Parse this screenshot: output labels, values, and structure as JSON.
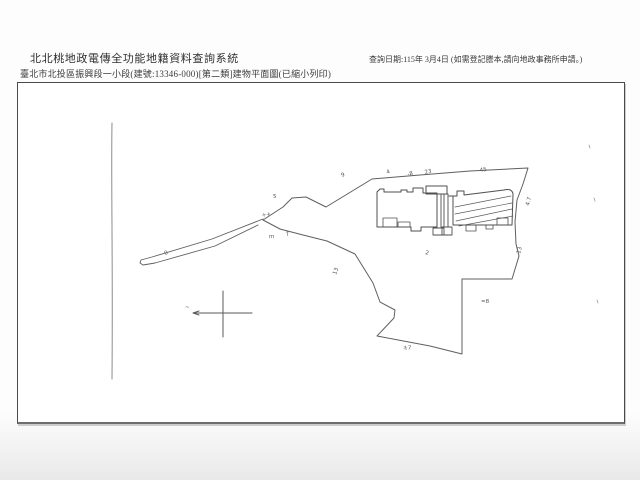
{
  "header": {
    "system_title": "北北桃地政電傳全功能地籍資料查詢系統",
    "document_title": "臺北市北投區振興段一小段(建號:13346-000)[第二類]建物平面圖(已縮小列印)",
    "query_date_note": "查詢日期:115年 3月4日 (如需登記謄本,請向地政事務所申請。)"
  },
  "drawing": {
    "stroke_color": "#5f5f5f",
    "annotation_color": "#555555",
    "paths": [
      {
        "d": "M112,123 C111,180 113,260 112,379",
        "c": "#8c8c8c",
        "w": 1
      },
      {
        "d": "M263,220 L283,207 L292,198 L306,197 L326,207 L372,179 L420,175 L470,171 L528,168 L523,184 L517,200 L515,222 L516,244 L519,256 L512,279 L462,279 L462,354 L430,346 L377,336 L394,318 L395,310 L380,302 L373,283 L355,254 L327,241 L303,235 L280,229 Z",
        "w": 1
      },
      {
        "d": "M263,219 L212,239 L152,257 L141,260 L140,263 L143,265 L155,263 L215,246 L258,225",
        "w": 0.9
      },
      {
        "d": "M377,192 L380,189 L384,189 L384,192 L401,192 L401,190 L407,190 L407,192 L413,192 L413,188 L423,188 L423,193 L437,193 L437,227 L421,227 L421,231 L411,231 L411,227 L377,227 Z",
        "c": "#4f4f4f",
        "w": 1
      },
      {
        "d": "M383,218 L397,218 L397,227 L383,227 Z",
        "c": "#4f4f4f",
        "w": 0.8
      },
      {
        "d": "M398,222 L410,222 L410,227 L398,227 Z",
        "c": "#4f4f4f",
        "w": 0.8
      },
      {
        "d": "M426,186 L447,186 L447,194 L426,194 Z",
        "c": "#4f4f4f",
        "w": 1
      },
      {
        "d": "M437,194 L441,194 L441,228 L437,228 Z",
        "c": "#4f4f4f",
        "w": 0.9
      },
      {
        "d": "M433,228 L444,228 L444,235 L433,235 Z",
        "c": "#4f4f4f",
        "w": 0.9
      },
      {
        "d": "M444,194 L448,194 L448,227 L444,227 Z",
        "c": "#4f4f4f",
        "w": 0.9
      },
      {
        "d": "M442,227 L452,227 L452,235 L442,235 Z",
        "c": "#4f4f4f",
        "w": 0.9
      },
      {
        "d": "M449,196 L453,196",
        "c": "#4f4f4f",
        "w": 0.9
      },
      {
        "d": "M453,196 L457,196 L457,191 L464,191 L464,195 L504,190 Q512,188 513,194 L512,225 L453,225 Z",
        "c": "#4f4f4f",
        "w": 1
      },
      {
        "d": "M497,218 L508,218 L508,225 L497,225 Z",
        "c": "#4f4f4f",
        "w": 0.8
      },
      {
        "d": "M455,207 L511,196 M455,214 L512,203 M456,221 L512,209 M459,226 L513,216",
        "c": "#5a5a5a",
        "w": 0.7
      },
      {
        "d": "M466,225 L466,231 L476,231 L476,225 M486,225 L486,229 L493,229 L493,225",
        "c": "#4f4f4f",
        "w": 0.8
      },
      {
        "d": "M193,313 L252,313 M223,291 L223,337 M199,311 L193,313 L199,315",
        "c": "#5a5a5a",
        "w": 1
      },
      {
        "d": "M589,145 l1,3 M594,198 l1,3 M597,300 l1,3",
        "c": "#9a9a9a",
        "w": 0.8
      }
    ],
    "annotations": [
      {
        "t": "9",
        "x": 342,
        "y": 177,
        "r": -25
      },
      {
        "t": "4",
        "x": 387,
        "y": 174,
        "r": -20
      },
      {
        "t": "-8",
        "x": 408,
        "y": 176,
        "r": -15
      },
      {
        "t": "23",
        "x": 425,
        "y": 174,
        "r": -12
      },
      {
        "t": "45",
        "x": 480,
        "y": 172,
        "r": -10
      },
      {
        "t": "5",
        "x": 273,
        "y": 198,
        "r": 0
      },
      {
        "t": "++",
        "x": 262,
        "y": 217,
        "r": -10
      },
      {
        "t": "7",
        "x": 286,
        "y": 236,
        "r": -10
      },
      {
        "t": "m",
        "x": 269,
        "y": 238,
        "r": 0
      },
      {
        "t": "0",
        "x": 165,
        "y": 255,
        "r": -20
      },
      {
        "t": "±7",
        "x": 403,
        "y": 349,
        "r": 5
      },
      {
        "t": "2",
        "x": 425,
        "y": 254,
        "r": 15
      },
      {
        "t": "13",
        "x": 336,
        "y": 275,
        "r": -70
      },
      {
        "t": "=8",
        "x": 481,
        "y": 303,
        "r": 0
      },
      {
        "t": "4.7",
        "x": 529,
        "y": 206,
        "r": -75
      },
      {
        "t": "13",
        "x": 520,
        "y": 254,
        "r": -75
      },
      {
        "t": "~",
        "x": 185,
        "y": 309,
        "r": 0
      }
    ]
  }
}
